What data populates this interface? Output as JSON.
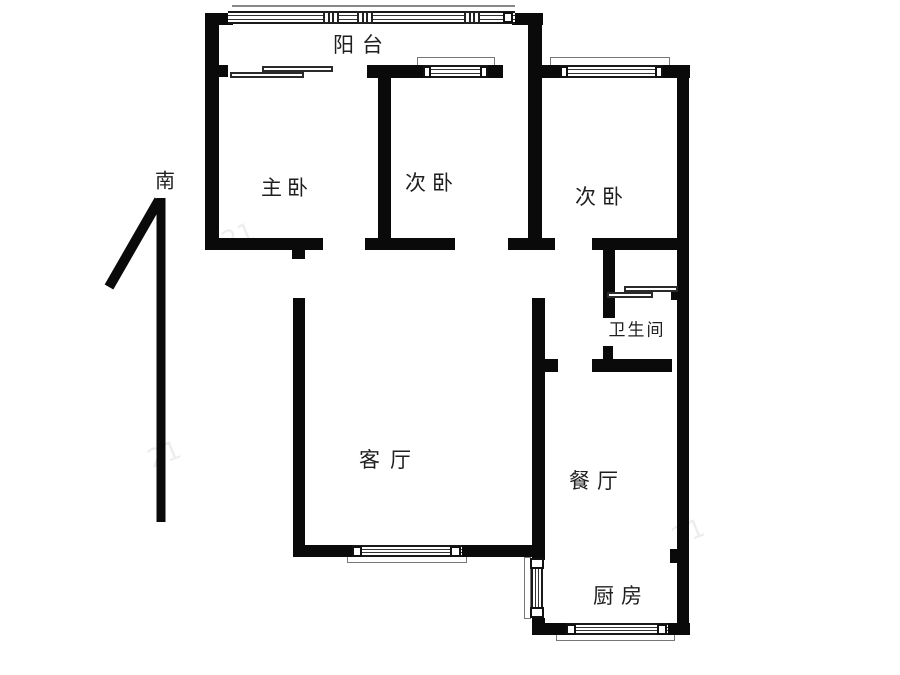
{
  "page": {
    "type": "apartment-floor-plan"
  },
  "compass": {
    "south": "南"
  },
  "rooms": {
    "balcony": {
      "label": "阳台"
    },
    "master_bedroom": {
      "label": "主卧"
    },
    "bedroom_middle": {
      "label": "次卧"
    },
    "bedroom_right": {
      "label": "次卧"
    },
    "bathroom": {
      "label": "卫生间"
    },
    "living_room": {
      "label": "客厅"
    },
    "dining_room": {
      "label": "餐厅"
    },
    "kitchen": {
      "label": "厨房"
    }
  },
  "watermark": {
    "text": "21"
  },
  "colors": {
    "wall": "#0a0a0a",
    "background": "#ffffff",
    "fixture_line": "#777777",
    "text": "#1f1f1f"
  }
}
